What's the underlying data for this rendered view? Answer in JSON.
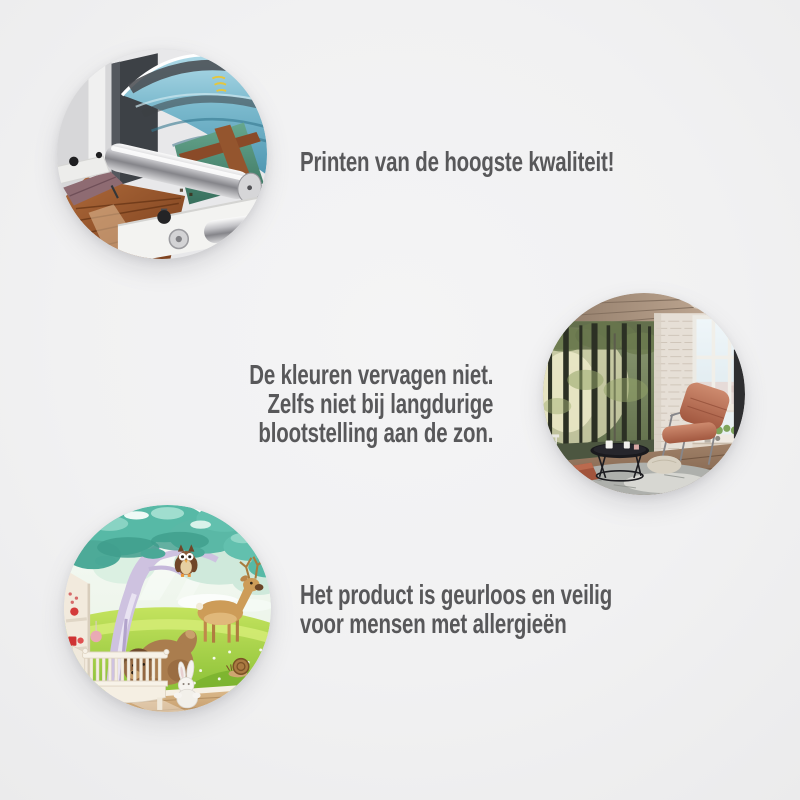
{
  "page": {
    "background_color": "#f0f0f1",
    "text_color": "#58585a"
  },
  "benefits": [
    {
      "image": "printing-machine-photo",
      "image_alt": "large-format printer with steel roller printing a canvas of a sea landscape and wooden pier",
      "lines": [
        "Printen van de hoogste kwaliteit!"
      ]
    },
    {
      "image": "living-room-forest-mural-photo",
      "image_alt": "loft living room with sunlit forest wall mural, white brick wall, window, salmon leather chair and black coffee table",
      "lines": [
        "De kleuren vervagen niet.",
        "Zelfs niet bij langdurige",
        "blootstelling aan de zon."
      ]
    },
    {
      "image": "nursery-cartoon-mural-photo",
      "image_alt": "children's room with cartoon wall mural of a tree, owl, deer and bear behind a white crib",
      "lines": [
        "Het product is geurloos en veilig",
        "voor mensen met allergieën"
      ]
    }
  ]
}
